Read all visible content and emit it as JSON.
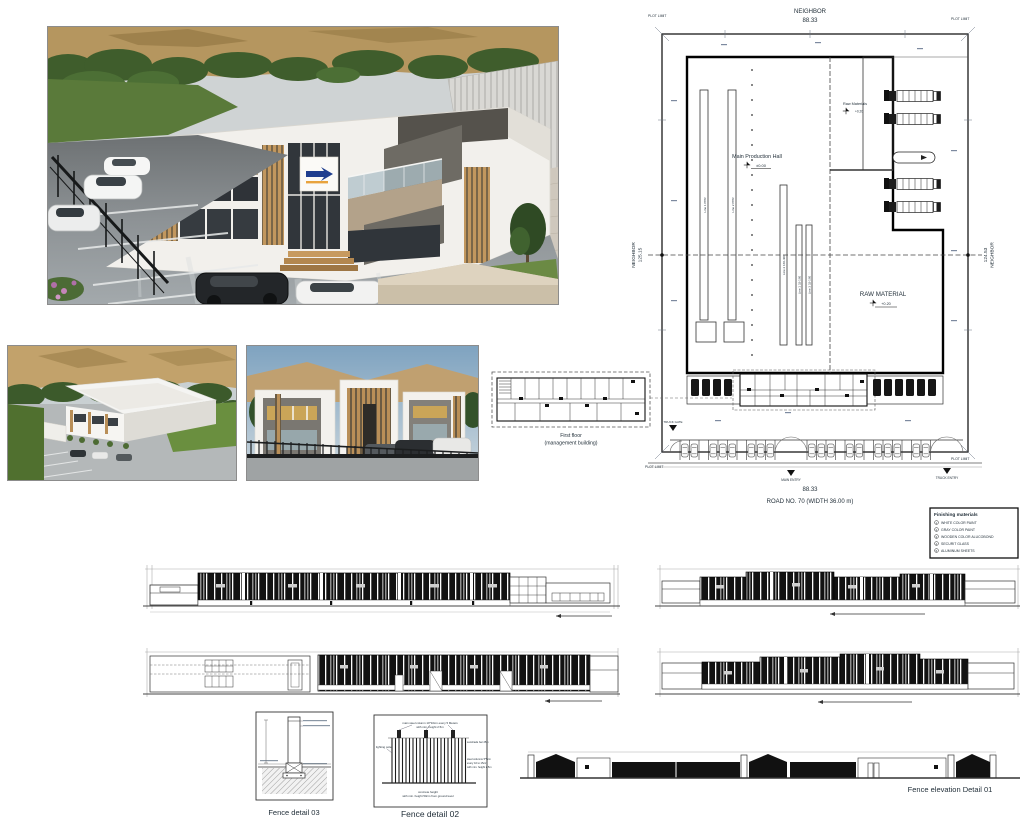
{
  "colors": {
    "line": "#1a1a1a",
    "dim_text": "#49576b",
    "wood_accent": "#c49a63",
    "taupe_panel": "#b3a28a",
    "dark_panel": "#6e6b64",
    "asphalt": "#83898c",
    "hill": "#b5965f",
    "tree": "#3f5d2c",
    "sky": "#aebfca",
    "fence_dark": "#141617"
  },
  "site_plan": {
    "neighbor_top_label": "NEIGHBOR",
    "neighbor_top_value": "88.33",
    "neighbor_left_label": "NEIGHBOR",
    "neighbor_left_value": "125.15",
    "neighbor_right_value": "124.53",
    "neighbor_right_label": "NEIGHBOR",
    "plot_limit": "PLOT LIMIT",
    "main_hall_label": "Main Production Hall",
    "main_hall_level": "±0.00",
    "raw_materials_small_label": "Raw Materials",
    "raw_materials_small_level": "+0.20",
    "raw_material_label": "RAW MATERIAL",
    "raw_material_level": "+0.20",
    "bottom_dim": "88.33",
    "road_label": "ROAD NO. 70 (WIDTH 36.00 m)",
    "entry_main": "MAIN ENTRY",
    "entry_truck": "TRUCK ENTRY",
    "gate_truck": "TRUCK GATE",
    "lines": [
      "Line 1 PPR",
      "Line 2 PPR",
      "Line 2 160-400",
      "Line 1 32-160",
      "Line 3 32-160"
    ],
    "legend": {
      "title": "Finishing materials",
      "items": [
        {
          "num": "1",
          "label": "WHITE COLOR PAINT"
        },
        {
          "num": "2",
          "label": "GRAY COLOR PAINT"
        },
        {
          "num": "3",
          "label": "WOODEN COLOR ALUCOBOND"
        },
        {
          "num": "4",
          "label": "SECURIT GLASS"
        },
        {
          "num": "5",
          "label": "ALUMINUM SHEETS"
        }
      ]
    }
  },
  "first_floor": {
    "caption_line1": "First floor",
    "caption_line2": "(management building)"
  },
  "fence": {
    "detail_03_caption": "Fence detail  03",
    "detail_02_caption": "Fence detail 02",
    "detail_01_caption": "Fence elevation  Detail 01",
    "d02_top_note_1": "main steel column 10*10cm every 5 Meters",
    "d02_top_note_2": "with min. height 2.5m",
    "d02_left_note": "lighting pole",
    "d02_right_note_1": "sunshade bar 25m",
    "d02_right_note_2": "steel columns 5*5cm",
    "d02_right_note_3": "every 10 to 15cm",
    "d02_right_note_4": "with min. height 2.5m",
    "d02_bottom_note_1": "concrete height",
    "d02_bottom_note_2": "with min. height 50cm from ground level"
  }
}
